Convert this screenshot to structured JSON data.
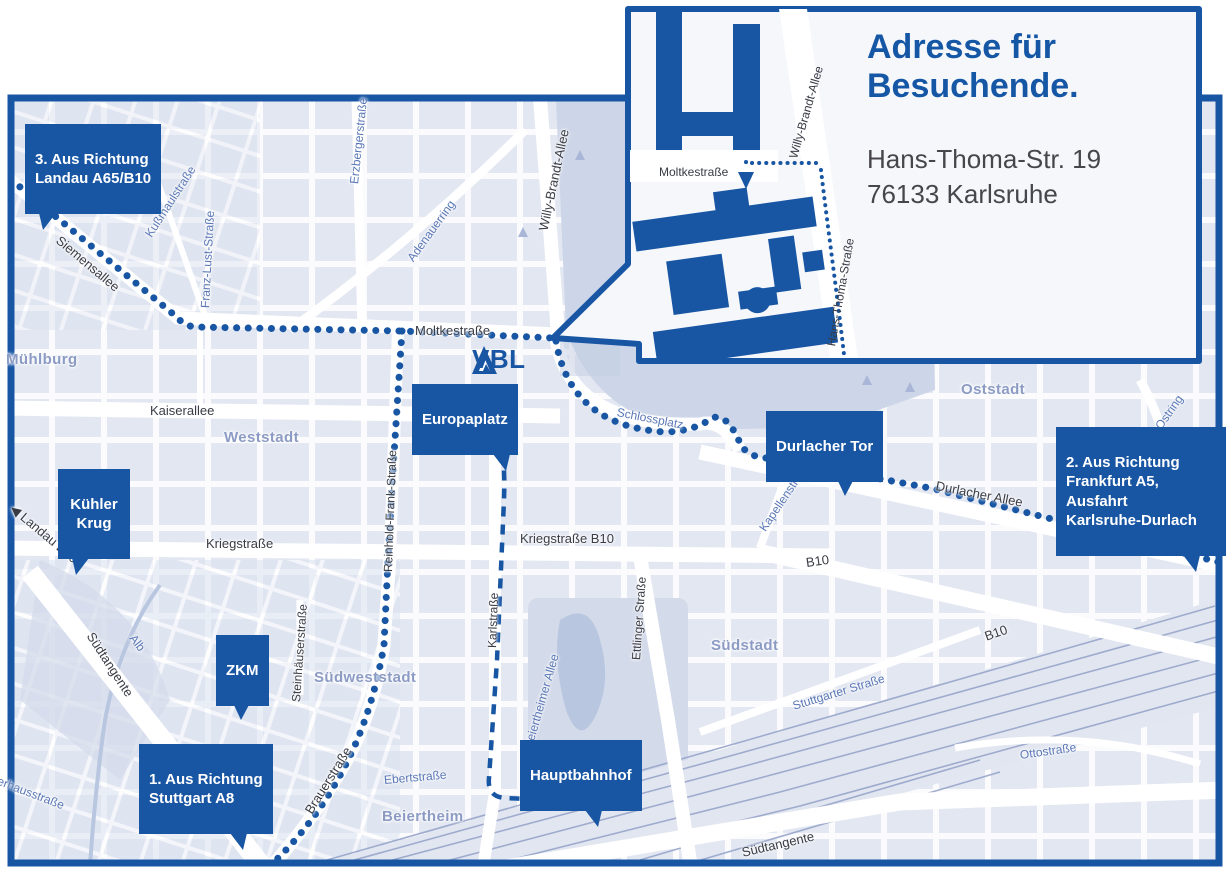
{
  "colors": {
    "brand_blue": "#1856a4",
    "map_bg": "#eef0f7",
    "block": "#dde3f0",
    "park": "#cdd6e8",
    "water": "#b9c6e0",
    "rail": "#97a5ca",
    "district_label": "#8c9bc4",
    "street_label": "#3a3c45",
    "blue_street_label": "#5b78b6"
  },
  "logo": {
    "text": "VBL"
  },
  "inset": {
    "title": "Adresse für\nBesuchende.",
    "address": {
      "line1": "Hans-Thoma-Str. 19",
      "line2": "76133 Karlsruhe"
    }
  },
  "callouts": {
    "landau": {
      "text": "3. Aus Richtung\nLandau A65/B10"
    },
    "frankfurt": {
      "text": "2. Aus Richtung\nFrankfurt A5,\nAusfahrt\nKarlsruhe-Durlach"
    },
    "stuttgart": {
      "text": "1. Aus Richtung\nStuttgart A8"
    },
    "europaplatz": {
      "text": "Europaplatz"
    },
    "durlacher_tor": {
      "text": "Durlacher Tor"
    },
    "kuehler_krug": {
      "text": "Kühler\nKrug"
    },
    "zkm": {
      "text": "ZKM"
    },
    "hauptbahnhof": {
      "text": "Hauptbahnhof"
    }
  },
  "map_labels": [
    {
      "text": "Siemensallee",
      "x": 58,
      "y": 232,
      "r": 40,
      "cls": "street"
    },
    {
      "text": "Kußmaulstraße",
      "x": 148,
      "y": 230,
      "r": -57,
      "cls": "street-blue"
    },
    {
      "text": "Franz-Lust-Straße",
      "x": 205,
      "y": 302,
      "r": -87,
      "cls": "street-blue"
    },
    {
      "text": "Erzbergerstraße",
      "x": 354,
      "y": 178,
      "r": -84,
      "cls": "street-blue"
    },
    {
      "text": "Adenauerring",
      "x": 410,
      "y": 254,
      "r": -54,
      "cls": "street-blue"
    },
    {
      "text": "Willy-Brandt-Allee",
      "x": 543,
      "y": 224,
      "r": -78,
      "cls": "street"
    },
    {
      "text": "Moltkestraße",
      "x": 415,
      "y": 324,
      "r": 0,
      "cls": "street"
    },
    {
      "text": "Mühlburg",
      "x": 6,
      "y": 352,
      "r": 0,
      "cls": "district"
    },
    {
      "text": "Kaiserallee",
      "x": 150,
      "y": 404,
      "r": 0,
      "cls": "street"
    },
    {
      "text": "Weststadt",
      "x": 224,
      "y": 430,
      "r": 0,
      "cls": "district"
    },
    {
      "text": "◀ Landau B10",
      "x": 12,
      "y": 500,
      "r": 40,
      "cls": "street"
    },
    {
      "text": "Kriegstraße",
      "x": 206,
      "y": 537,
      "r": 0,
      "cls": "street"
    },
    {
      "text": "Kriegstraße B10",
      "x": 520,
      "y": 532,
      "r": 0,
      "cls": "street"
    },
    {
      "text": "Reinhold-Frank-Straße",
      "x": 388,
      "y": 566,
      "r": -88,
      "cls": "street-sm"
    },
    {
      "text": "Karlstraße",
      "x": 492,
      "y": 642,
      "r": -88,
      "cls": "street-sm"
    },
    {
      "text": "Ettlinger Straße",
      "x": 636,
      "y": 654,
      "r": -86,
      "cls": "street-sm"
    },
    {
      "text": "Schlossplatz",
      "x": 617,
      "y": 406,
      "r": 11,
      "cls": "street-blue"
    },
    {
      "text": "Durlacher Tor",
      "x": 0,
      "y": 0,
      "r": 0,
      "cls": "hidden-none"
    },
    {
      "text": "Oststadt",
      "x": 961,
      "y": 382,
      "r": 0,
      "cls": "district"
    },
    {
      "text": "Kapellenstraße",
      "x": 762,
      "y": 524,
      "r": -56,
      "cls": "street-blue"
    },
    {
      "text": "Durlacher Allee",
      "x": 936,
      "y": 479,
      "r": 11,
      "cls": "street"
    },
    {
      "text": "Ostring",
      "x": 1158,
      "y": 422,
      "r": -55,
      "cls": "street-blue"
    },
    {
      "text": "Ostring",
      "x": 1170,
      "y": 523,
      "r": -62,
      "cls": "street-blue"
    },
    {
      "text": "B10",
      "x": 806,
      "y": 556,
      "r": -8,
      "cls": "street"
    },
    {
      "text": "B10",
      "x": 985,
      "y": 630,
      "r": -19,
      "cls": "street"
    },
    {
      "text": "Südstadt",
      "x": 711,
      "y": 638,
      "r": 0,
      "cls": "district"
    },
    {
      "text": "Stuttgarter Straße",
      "x": 793,
      "y": 700,
      "r": -17,
      "cls": "street-blue"
    },
    {
      "text": "Ottostraße",
      "x": 1020,
      "y": 749,
      "r": -8,
      "cls": "street-blue"
    },
    {
      "text": "Südtangente",
      "x": 742,
      "y": 846,
      "r": -13,
      "cls": "street"
    },
    {
      "text": "Südtangente",
      "x": 90,
      "y": 627,
      "r": 57,
      "cls": "street"
    },
    {
      "text": "Alb",
      "x": 132,
      "y": 630,
      "r": 52,
      "cls": "street-blue"
    },
    {
      "text": "Steinhäuserstraße",
      "x": 296,
      "y": 696,
      "r": -86,
      "cls": "street-sm"
    },
    {
      "text": "Südweststadt",
      "x": 314,
      "y": 670,
      "r": 0,
      "cls": "district"
    },
    {
      "text": "Brauerstraße",
      "x": 308,
      "y": 806,
      "r": -58,
      "cls": "street"
    },
    {
      "text": "Ebertstraße",
      "x": 384,
      "y": 774,
      "r": -5,
      "cls": "street-blue"
    },
    {
      "text": "Beiertheim",
      "x": 382,
      "y": 809,
      "r": 0,
      "cls": "district"
    },
    {
      "text": "Beiertheimer Allee",
      "x": 528,
      "y": 742,
      "r": -74,
      "cls": "street-blue"
    },
    {
      "text": "Pulverhausstraße",
      "x": -24,
      "y": 766,
      "r": 21,
      "cls": "street-blue"
    },
    {
      "text": "Moltkestraße",
      "x": 659,
      "y": 166,
      "r": 0,
      "cls": "inset-street"
    },
    {
      "text": "Willy-Brandt-Allee",
      "x": 793,
      "y": 152,
      "r": -74,
      "cls": "inset-street"
    },
    {
      "text": "Hans-Thoma-Straße",
      "x": 831,
      "y": 340,
      "r": -80,
      "cls": "inset-street"
    }
  ]
}
